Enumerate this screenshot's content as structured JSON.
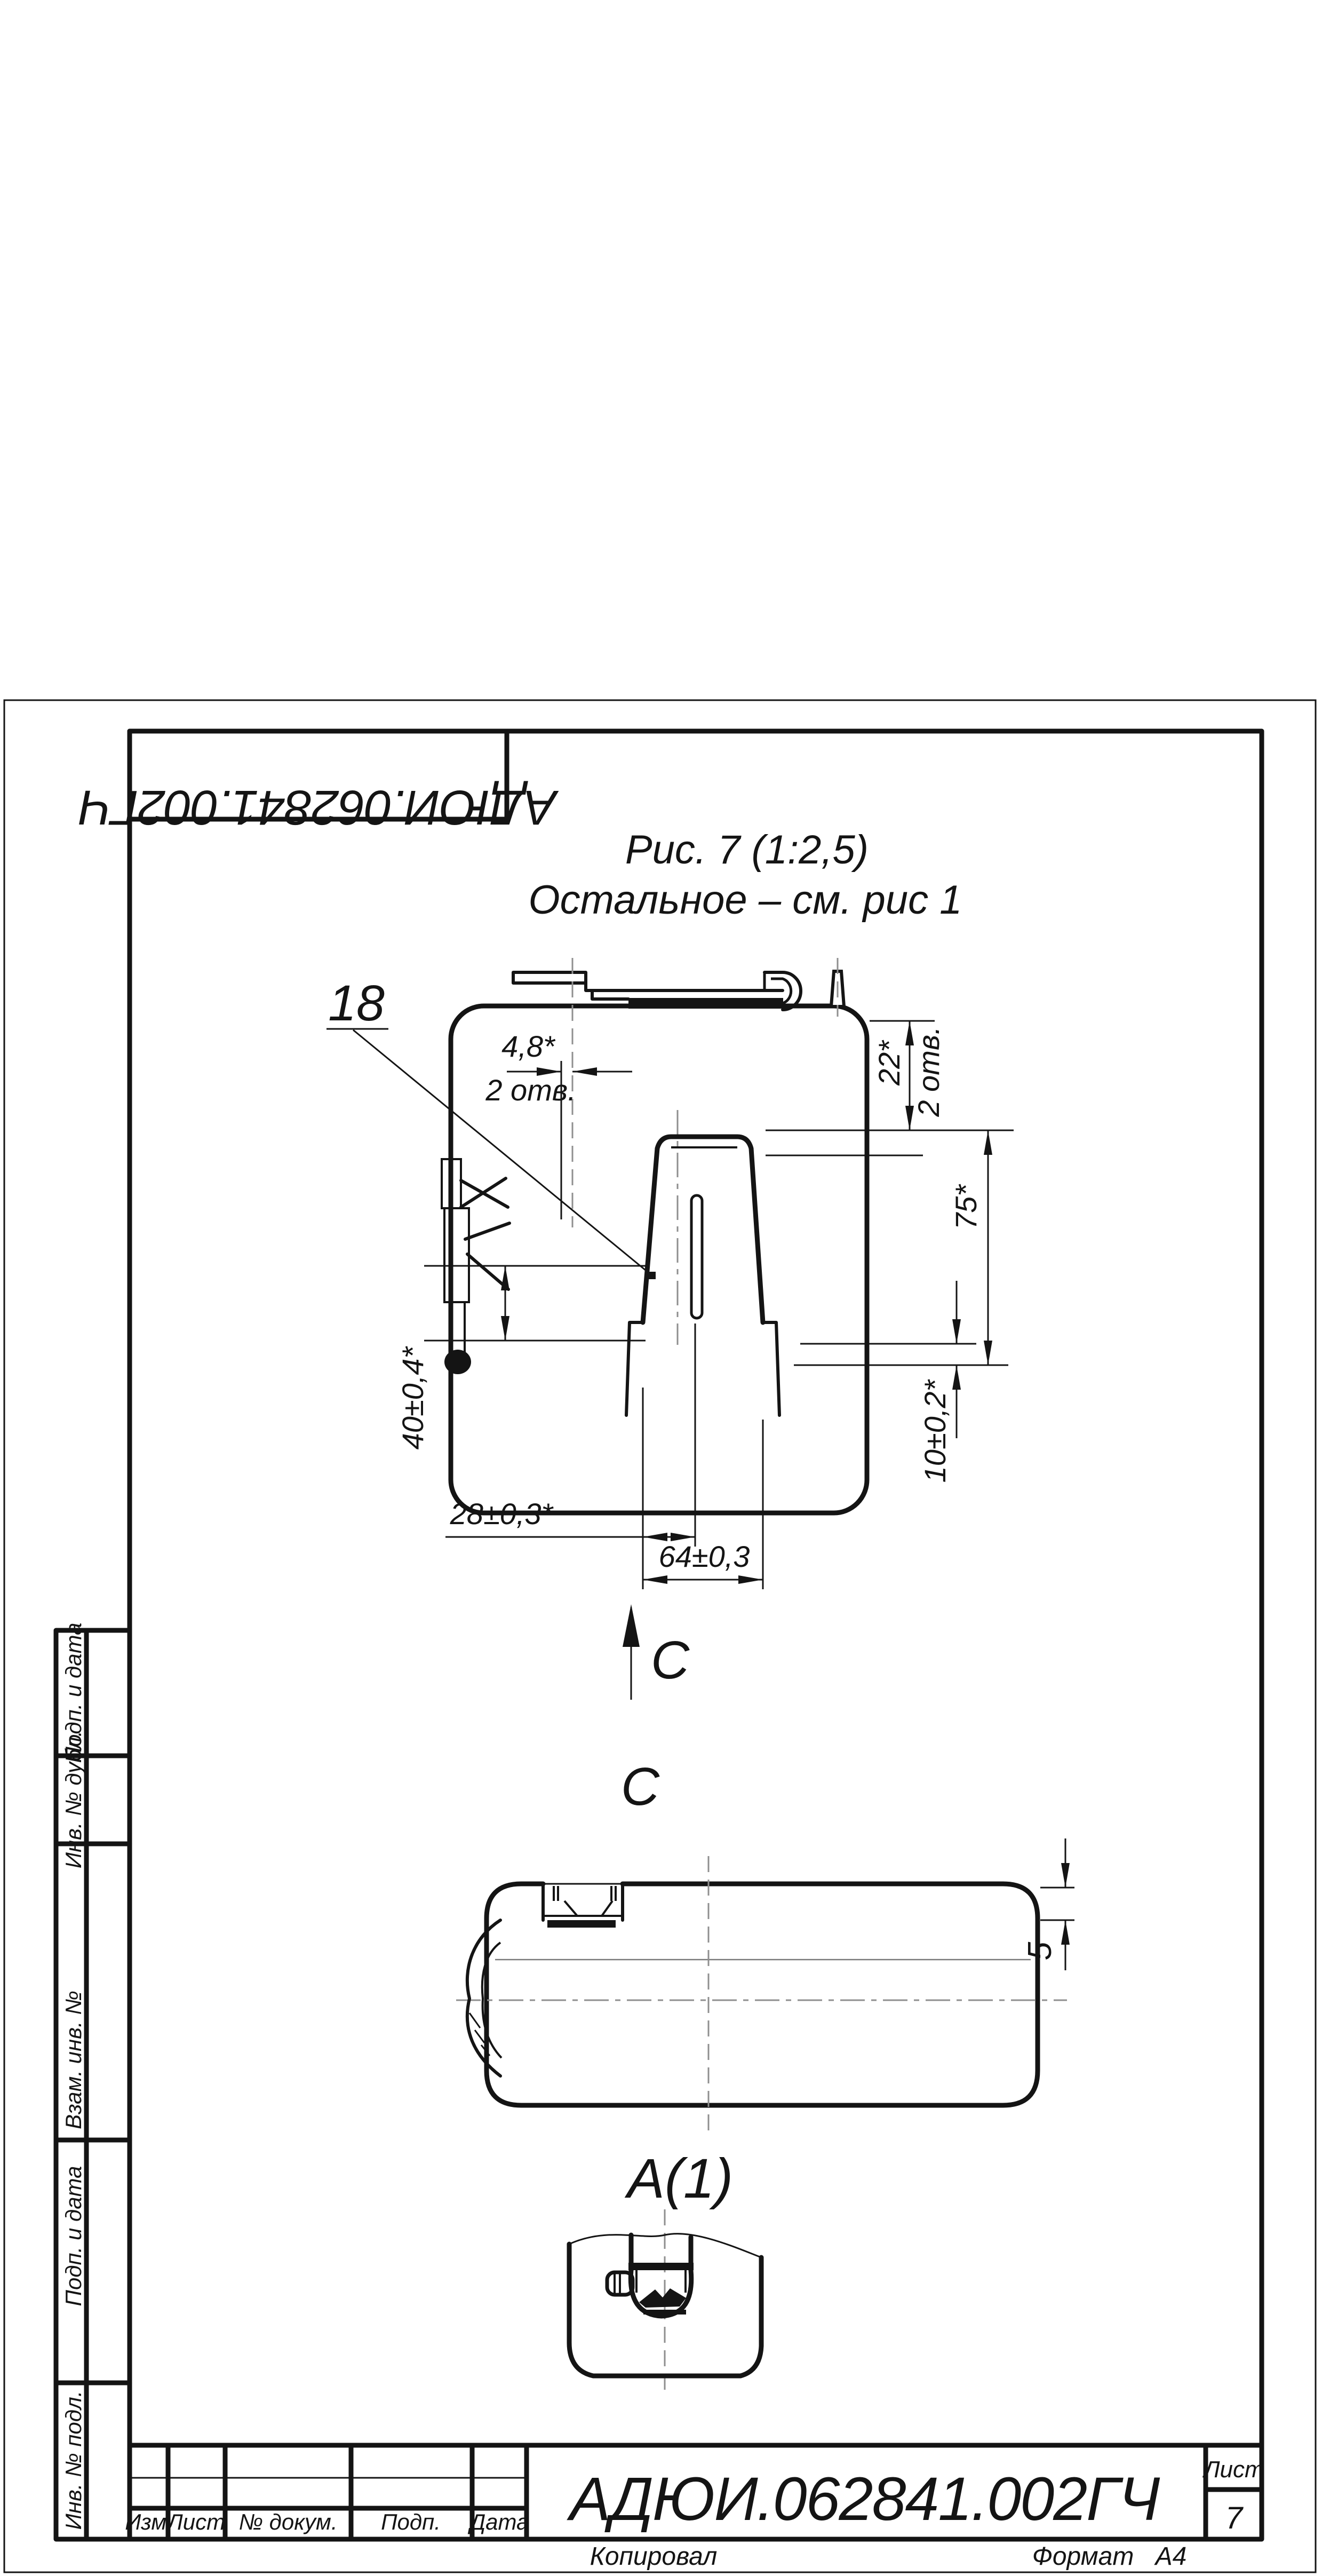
{
  "document": {
    "number": "АДЮИ.062841.002ГЧ",
    "number_rotated": "АДЮИ.062841.002ГЧ"
  },
  "caption": {
    "line1": "Рис. 7  (1:2,5)",
    "line2": "Остальное – см. рис 1"
  },
  "callout": {
    "part_number": "18"
  },
  "dimensions": {
    "d48": "4,8*",
    "d48_note": "2 отв.",
    "d22": "22*",
    "d22_note": "2 отв.",
    "d75": "75*",
    "d10": "10±0,2*",
    "d40": "40±0,4*",
    "d28": "28±0,3*",
    "d64": "64±0,3",
    "d5": "5"
  },
  "views": {
    "arrow_label": "С",
    "section_label": "С",
    "detail_label": "А(1)"
  },
  "sidebar": {
    "items": [
      {
        "label": "Подп. и дата"
      },
      {
        "label": "Инв. № дубл."
      },
      {
        "label": "Взам. инв. №"
      },
      {
        "label": "Подп. и дата"
      },
      {
        "label": "Инв. № подл."
      }
    ]
  },
  "title_block": {
    "col_izm": "Изм.",
    "col_list": "Лист",
    "col_doc": "№ докум.",
    "col_podp": "Подп.",
    "col_data": "Дата",
    "doc_number": "АДЮИ.062841.002ГЧ",
    "sheet_header": "Лист",
    "sheet_number": "7",
    "copied": "Копировал",
    "format_label": "Формат",
    "format_value": "А4"
  }
}
